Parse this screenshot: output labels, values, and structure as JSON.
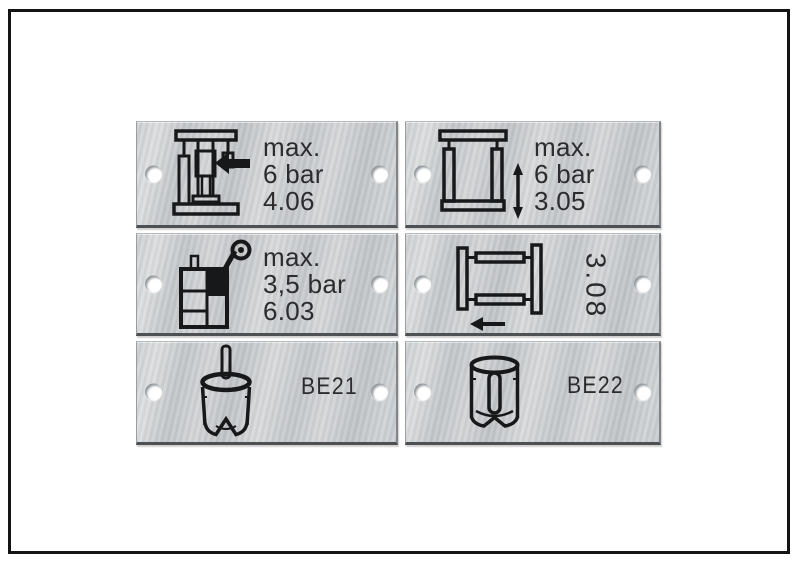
{
  "figure": {
    "background": "#ffffff",
    "border_color": "#141414",
    "description": "Six brushed-aluminium machine labels in two columns and three rows, each with two mounting holes"
  },
  "plate_style": {
    "base_color": "#c9cccf",
    "edge_shadow_color": "#4e5154",
    "engraving_color": "#2c2c2f",
    "hole_color": "#ffffff"
  },
  "plates": [
    {
      "name": "label-plate-4-06",
      "icon": "press-clamp-left-arrow-icon",
      "lines": [
        "max.",
        "6 bar",
        "4.06"
      ],
      "text_rotation_deg": 0
    },
    {
      "name": "label-plate-3-05",
      "icon": "frame-vertical-double-arrow-icon",
      "lines": [
        "max.",
        "6 bar",
        "3.05"
      ],
      "text_rotation_deg": 0
    },
    {
      "name": "label-plate-6-03",
      "icon": "tank-spray-nozzle-icon",
      "lines": [
        "max.",
        "3,5 bar",
        "6.03"
      ],
      "text_rotation_deg": 0
    },
    {
      "name": "label-plate-3-08",
      "icon": "frame-left-arrow-icon",
      "lines": [
        "3.08"
      ],
      "text_rotation_deg": 90
    },
    {
      "name": "label-plate-be21",
      "icon": "notched-die-cylinder-icon",
      "lines": [
        "BE21"
      ],
      "text_rotation_deg": 0
    },
    {
      "name": "label-plate-be22",
      "icon": "die-cylinder-center-pin-icon",
      "lines": [
        "BE22"
      ],
      "text_rotation_deg": 0
    }
  ]
}
